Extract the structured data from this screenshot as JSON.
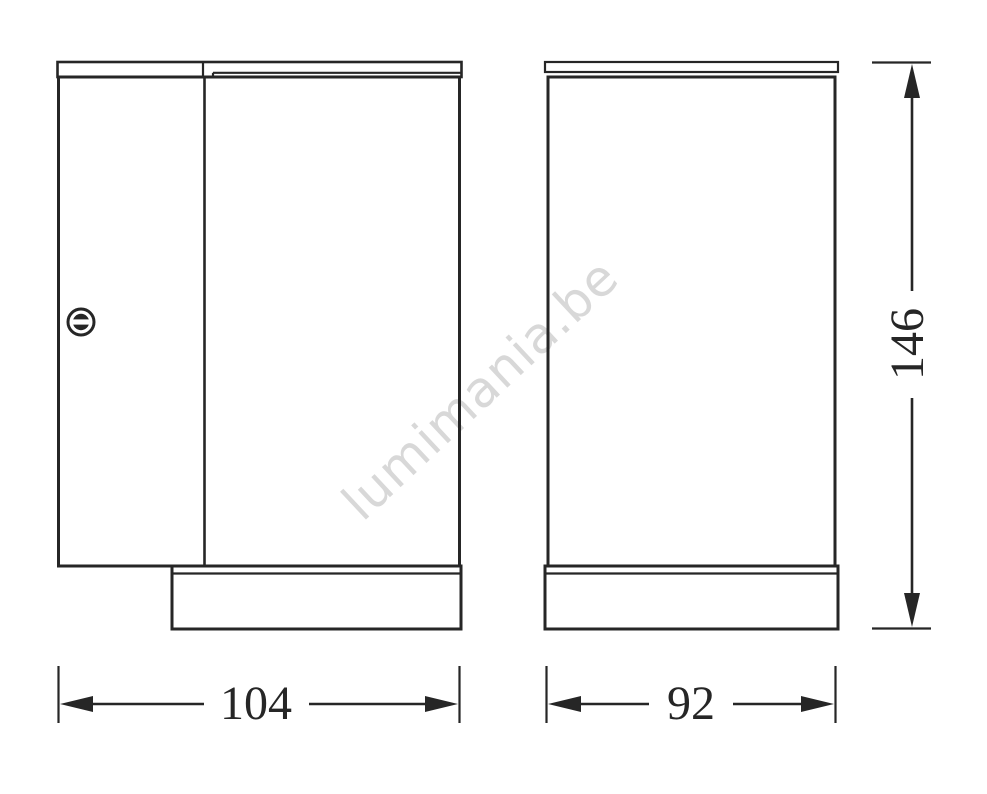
{
  "page": {
    "background": "#ffffff"
  },
  "watermark": {
    "text": "lumimania.be",
    "color": "#d8d8d8"
  },
  "dimensions": {
    "side_view_width": "104",
    "front_view_width": "92",
    "overall_height": "146"
  },
  "icons": {
    "screw": "slotted-screw-head"
  },
  "colors": {
    "line": "#262626"
  }
}
